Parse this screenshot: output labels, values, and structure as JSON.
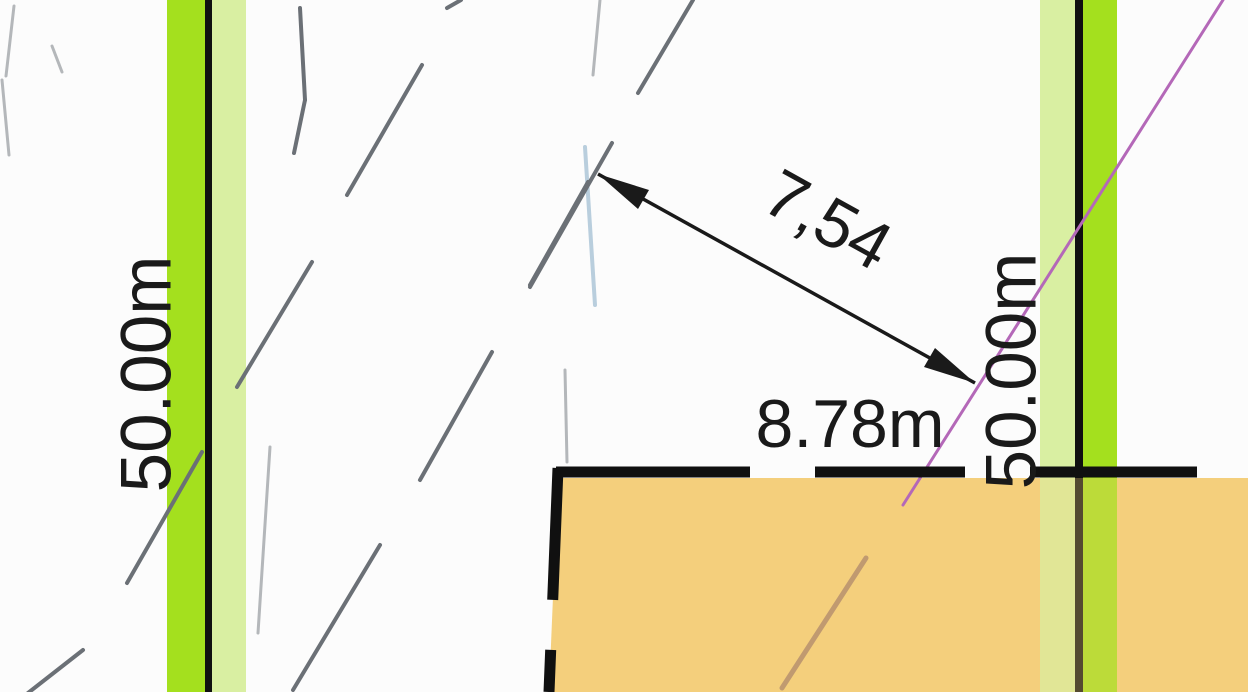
{
  "drawing": {
    "type": "cadastral-site-plan",
    "labels": {
      "left_boundary_length": "50.00m",
      "right_boundary_length": "50.00m",
      "diagonal_dimension": "7,54",
      "setback_dimension": "8.78m"
    },
    "colors": {
      "background": "#fcfcfc",
      "buffer_bright_green": "#a4e01e",
      "buffer_light_green": "#d9efa2",
      "boundary_black": "#101010",
      "building_fill_orange": "#f4cf7c",
      "building_tint_orange": "#f4cf7c",
      "dimension_black": "#1a1a1a",
      "sketch_dark_gray": "#6b7076",
      "sketch_light_gray": "#b4b7ba",
      "sketch_light_blue": "#b9cedd",
      "survey_magenta": "#b468b8",
      "terrain_tan": "#c09a70"
    }
  }
}
